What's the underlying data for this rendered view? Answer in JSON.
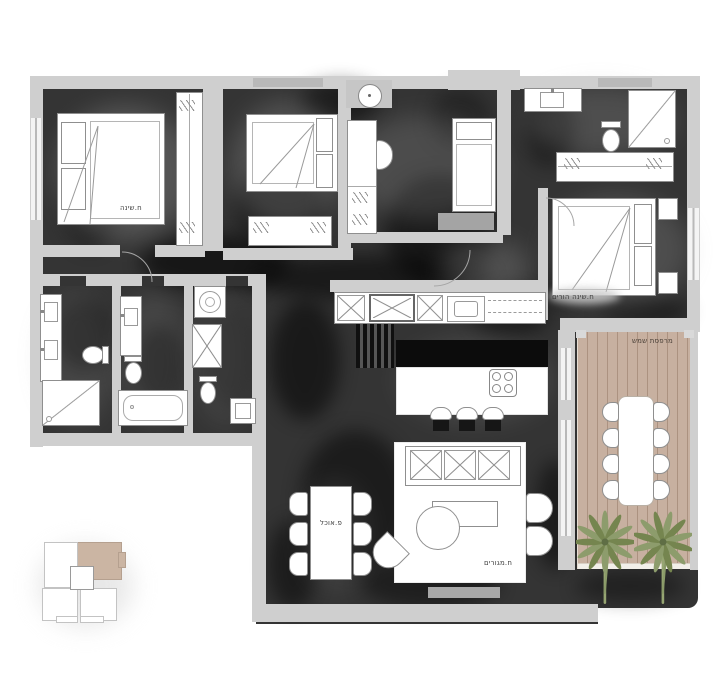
{
  "document": {
    "type": "apartment-floor-plan",
    "language": "he"
  },
  "labels": {
    "bedroom": "ח.שינה",
    "master_bedroom": "ח.שינה הורים",
    "dining_nook": "פ.אוכל",
    "living_room": "ח.מגורים",
    "sun_terrace": "מרפסת שמש"
  },
  "colors": {
    "page_bg": "#ffffff",
    "floor_dark": "#343434",
    "floor_shadow": "#0f0f0f",
    "wall_gray": "#cfcfcf",
    "furniture_white": "#ffffff",
    "furniture_line": "#8f8f8f",
    "deck_wood": "#c7b0a0",
    "deck_plank_line": "#b49c8c",
    "palm_green": "#8a9a68",
    "collage_tan": "#cbb5a3",
    "label_text": "#3d3d3d"
  }
}
